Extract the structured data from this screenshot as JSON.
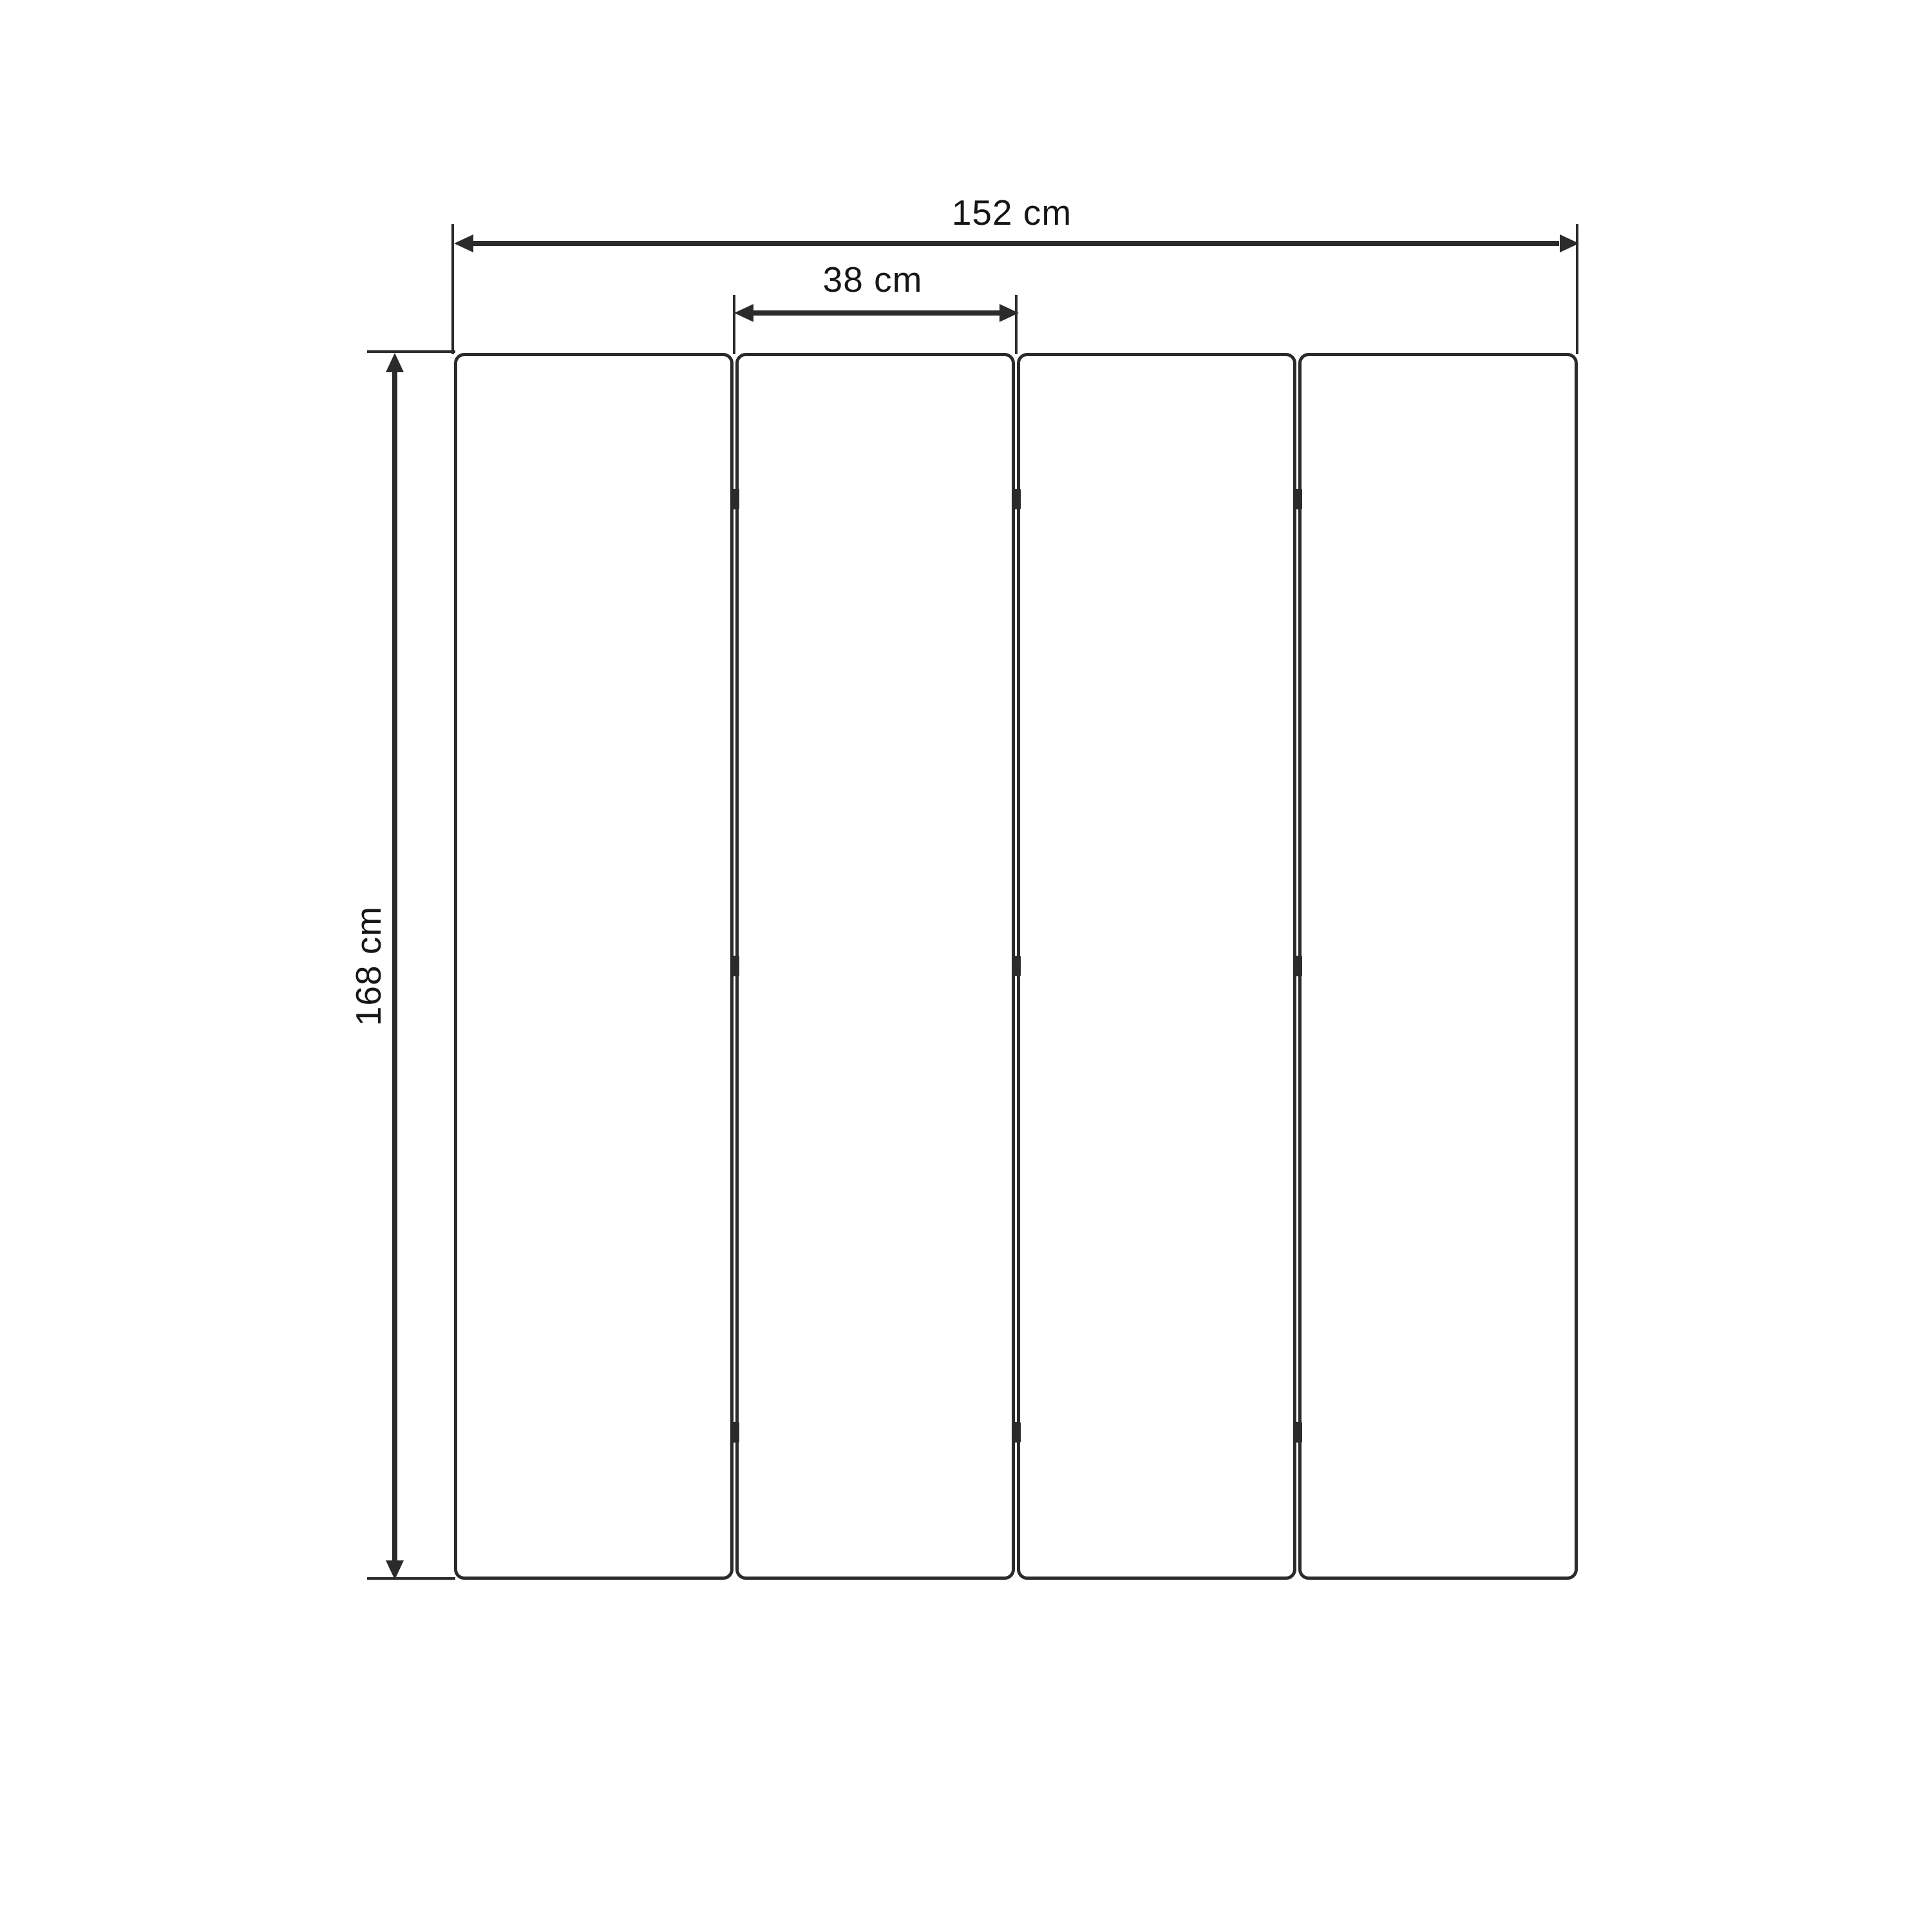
{
  "diagram": {
    "type": "folding-screen-dimension-diagram",
    "panel_count": 4,
    "hinge_rows": 3,
    "labels": {
      "total_width": "152 cm",
      "panel_width": "38 cm",
      "height": "168 cm"
    },
    "colors": {
      "background": "#ffffff",
      "line": "#2b2b2b",
      "text": "#161616"
    }
  }
}
